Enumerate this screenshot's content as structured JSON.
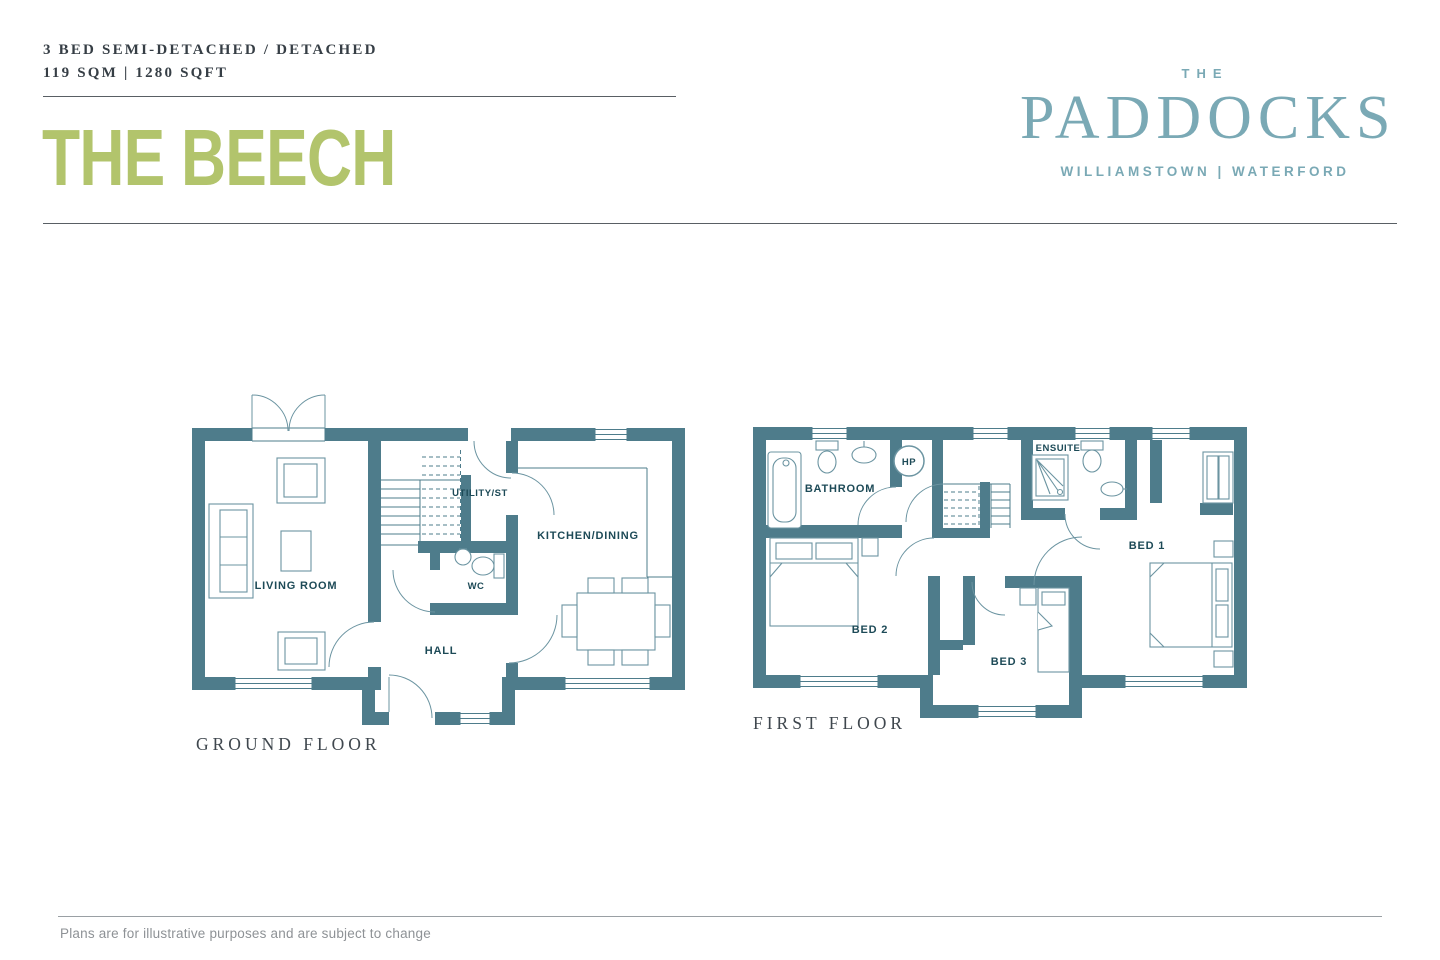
{
  "header": {
    "spec_line": "3 BED SEMI-DETACHED / DETACHED",
    "area_line": "119 SQM | 1280 SQFT",
    "house_name": "THE BEECH"
  },
  "brand": {
    "the": "THE",
    "name": "PADDOCKS",
    "location": "WILLIAMSTOWN | WATERFORD"
  },
  "plans": {
    "ground": {
      "caption": "GROUND FLOOR",
      "living": "LIVING ROOM",
      "utility": "UTILITY/ST",
      "kitchen": "KITCHEN/DINING",
      "wc": "WC",
      "hall": "HALL"
    },
    "first": {
      "caption": "FIRST FLOOR",
      "bathroom": "BATHROOM",
      "ensuite": "ENSUITE",
      "hp": "HP",
      "bed1": "BED 1",
      "bed2": "BED 2",
      "bed3": "BED 3"
    }
  },
  "footer": {
    "disclaimer": "Plans are for illustrative purposes and are subject to change"
  },
  "colors": {
    "wall": "#4e7c8b",
    "line": "#4e7c8b",
    "furn": "#6b94a1",
    "label": "#1d4a57",
    "accent_green": "#b2c46c",
    "brand_teal": "#7aa9b5",
    "text_dark": "#363e45",
    "muted": "#8e9296",
    "rule": "#595f64"
  }
}
